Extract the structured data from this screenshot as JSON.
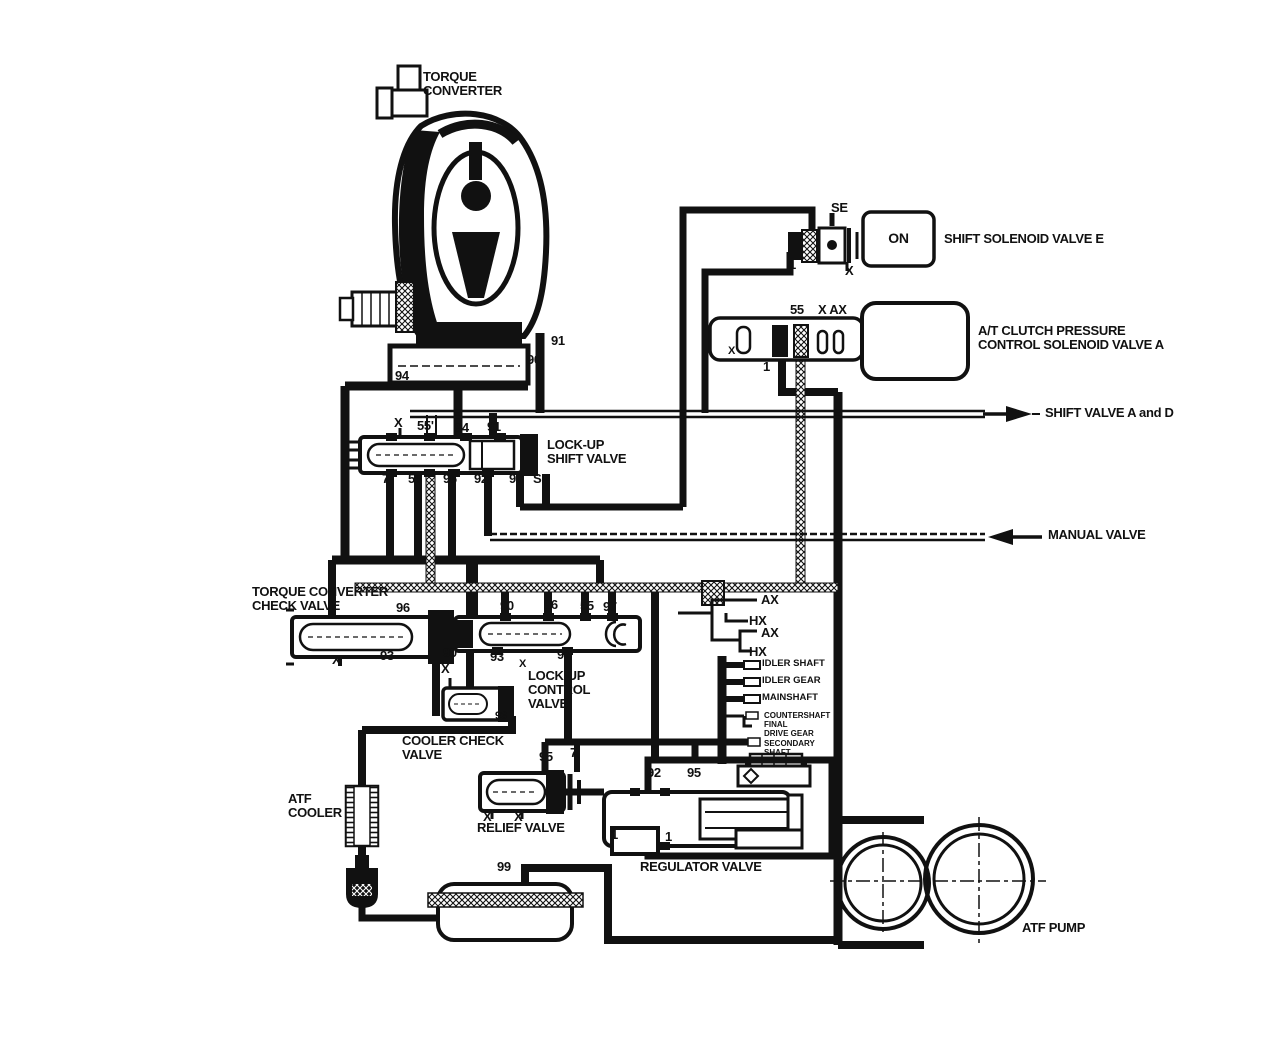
{
  "diagram": {
    "title": "Automatic transmission hydraulic circuit",
    "colors": {
      "ink": "#111111",
      "background": "#ffffff"
    },
    "labels": {
      "torque_converter": "TORQUE\nCONVERTER",
      "shift_solenoid_e": "SHIFT SOLENOID VALVE E",
      "solenoid_on": "ON",
      "at_clutch_solenoid": "A/T CLUTCH PRESSURE\nCONTROL SOLENOID VALVE A",
      "shift_valve_ad": "SHIFT VALVE A and D",
      "manual_valve": "MANUAL VALVE",
      "lockup_shift_valve": "LOCK-UP\nSHIFT VALVE",
      "tc_check_valve": "TORQUE CONVERTER\nCHECK VALVE",
      "lockup_control_valve": "LOCK-UP\nCONTROL\nVALVE",
      "cooler_check_valve": "COOLER CHECK\nVALVE",
      "atf_cooler": "ATF\nCOOLER",
      "relief_valve": "RELIEF VALVE",
      "regulator_valve": "REGULATOR VALVE",
      "atf_pump": "ATF PUMP",
      "idler_shaft": "IDLER SHAFT",
      "idler_gear": "IDLER GEAR",
      "mainshaft": "MAINSHAFT",
      "countershaft": "COUNTERSHAFT",
      "final_drive_gear": "FINAL\nDRIVE GEAR",
      "secondary_shaft": "SECONDARY\nSHAFT"
    },
    "ports": {
      "p1": "1",
      "p7": "7",
      "p55": "55",
      "p55_prime": "55'",
      "p90": "90",
      "p91": "91",
      "p92": "92",
      "p93": "93",
      "p94": "94",
      "p95": "95",
      "p96": "96",
      "p97": "97",
      "p99": "99",
      "se": "SE",
      "x": "X",
      "ax": "AX",
      "hx": "HX",
      "x_ax": "X AX"
    }
  }
}
